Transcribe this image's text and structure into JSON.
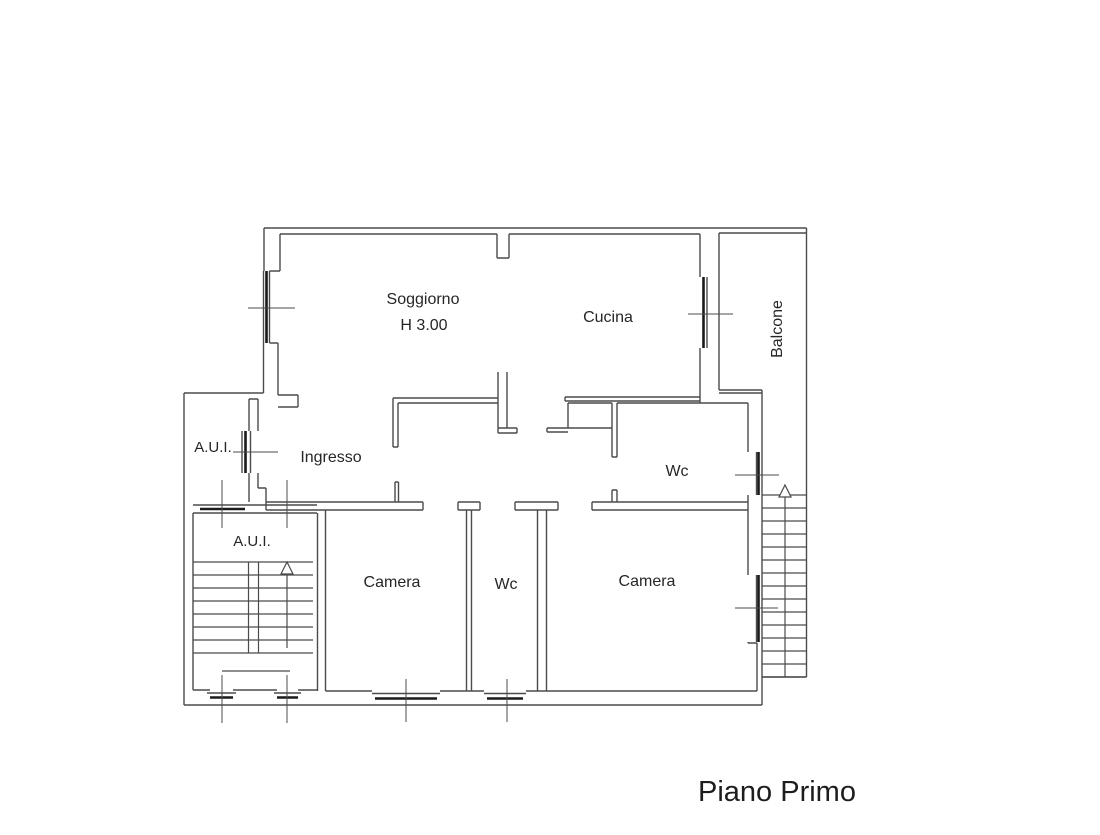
{
  "colors": {
    "background": "#ffffff",
    "wall_line": "#4b4b4b",
    "window_glass": "#1a1a1a",
    "text": "#262626"
  },
  "plan": {
    "title": "Piano Primo",
    "rooms": {
      "soggiorno": {
        "label": "Soggiorno",
        "height_note": "H 3.00"
      },
      "cucina": {
        "label": "Cucina"
      },
      "balcone": {
        "label": "Balcone"
      },
      "aui_upper": {
        "label": "A.U.I."
      },
      "ingresso": {
        "label": "Ingresso"
      },
      "wc_upper": {
        "label": "Wc"
      },
      "aui_stairwell": {
        "label": "A.U.I."
      },
      "camera_left": {
        "label": "Camera"
      },
      "wc_lower": {
        "label": "Wc"
      },
      "camera_right": {
        "label": "Camera"
      }
    }
  }
}
